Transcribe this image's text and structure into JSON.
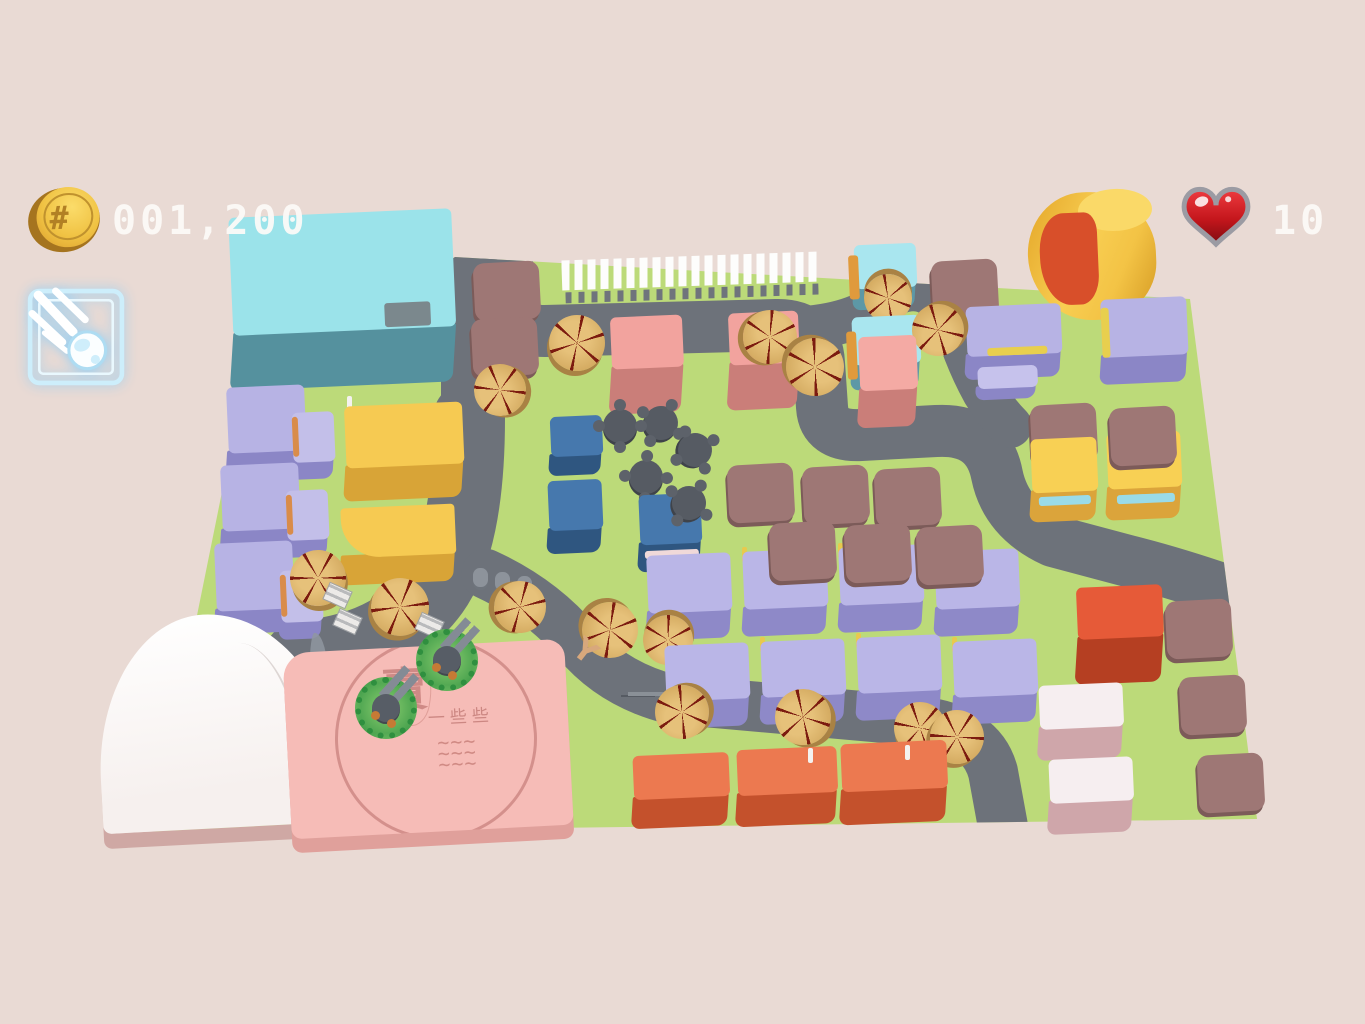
{
  "hud": {
    "coins": "001,200",
    "lives": "10",
    "coin_icon": "gold-coin",
    "heart_icon": "red-heart",
    "ability_icon": "meteor-spell",
    "coin_symbol": "#",
    "text_color": "#fdfbf8"
  },
  "colors": {
    "background": "#e9dad4",
    "ground": "#bcda79",
    "road": "#6d727a",
    "pad": "#9e7775",
    "tree_top": "#d9b369",
    "tree_spokes": "#7c1b10",
    "plaza": "#f6bcb7",
    "heart_red": "#d01f24",
    "ability_blue": "#bfe7f7"
  },
  "plaza": {
    "stamp_main": "賣",
    "stamp_small": "一些些",
    "stamp_waves": "~~~\n~~~\n~~~"
  },
  "map": {
    "ground_clip": "polygon(455px 257px, 1190px 299px, 1257px 819px, 153px 833px, 242px 393px)",
    "roads": [
      {
        "d": "M507,248 L507,296 Q507,331 545,331 L776,325 Q817,324 819,363 L822,407 Q824,437 861,435 L936,431 Q988,428 997,475 Q1006,519 1053,541 L1128,561 Q1180,574 1242,596",
        "w": 52
      },
      {
        "d": "M469,252 L469,430",
        "w": 56
      },
      {
        "d": "M469,418 Q469,542 433,592 Q398,640 328,653 L300,657",
        "w": 72
      },
      {
        "d": "M486,574 Q542,600 577,642 Q612,684 670,699 L918,721 Q981,728 993,772 L1004,832",
        "w": 50
      },
      {
        "d": "M788,329 Q852,327 882,302 Q906,283 927,292 Q950,303 958,331 Q968,363 984,392 Q996,412 1010,426",
        "w": 44
      }
    ],
    "buildings": [
      {
        "n": "cyan-building",
        "x": 232,
        "y": 213,
        "w": 223,
        "h": 118,
        "ex": 58,
        "top": "#9be3ea",
        "side": "#55919e",
        "acc": [
          {
            "x": 152,
            "y": 92,
            "w": 46,
            "h": 24,
            "c": "#7b888d"
          }
        ]
      },
      {
        "n": "lavender-building",
        "x": 228,
        "y": 386,
        "w": 78,
        "h": 66,
        "ex": 26,
        "top": "#b7b3e4",
        "side": "#8b86c6"
      },
      {
        "n": "lavender-building",
        "x": 293,
        "y": 412,
        "w": 42,
        "h": 50,
        "ex": 20,
        "top": "#c3bfe9",
        "side": "#8b86c6",
        "acc": [
          {
            "x": 0,
            "y": 4,
            "w": 6,
            "h": 40,
            "c": "#d98c4a"
          }
        ]
      },
      {
        "n": "lavender-building",
        "x": 222,
        "y": 464,
        "w": 78,
        "h": 66,
        "ex": 26,
        "top": "#b7b3e4",
        "side": "#8b86c6"
      },
      {
        "n": "lavender-building",
        "x": 287,
        "y": 490,
        "w": 42,
        "h": 50,
        "ex": 20,
        "top": "#c3bfe9",
        "side": "#8b86c6",
        "acc": [
          {
            "x": 0,
            "y": 4,
            "w": 6,
            "h": 40,
            "c": "#d98c4a"
          }
        ]
      },
      {
        "n": "lavender-building",
        "x": 216,
        "y": 542,
        "w": 78,
        "h": 68,
        "ex": 26,
        "top": "#b7b3e4",
        "side": "#8b86c6"
      },
      {
        "n": "lavender-building",
        "x": 281,
        "y": 570,
        "w": 42,
        "h": 52,
        "ex": 20,
        "top": "#c3bfe9",
        "side": "#8b86c6",
        "acc": [
          {
            "x": 0,
            "y": 4,
            "w": 6,
            "h": 42,
            "c": "#d98c4a"
          }
        ]
      },
      {
        "n": "yellow-building",
        "x": 346,
        "y": 404,
        "w": 118,
        "h": 62,
        "ex": 36,
        "top": "#f6ca52",
        "side": "#d8a437"
      },
      {
        "n": "yellow-building",
        "x": 342,
        "y": 506,
        "w": 114,
        "h": 50,
        "ex": 30,
        "top": "#f6ca52",
        "side": "#d8a437",
        "rad": "4px 4px 4px 38px"
      },
      {
        "n": "pink-building",
        "x": 612,
        "y": 316,
        "w": 72,
        "h": 52,
        "ex": 48,
        "top": "#f2a39e",
        "side": "#ca7e79"
      },
      {
        "n": "pink-building",
        "x": 730,
        "y": 312,
        "w": 70,
        "h": 52,
        "ex": 48,
        "top": "#f2a39e",
        "side": "#ca7e79"
      },
      {
        "n": "pink-building",
        "x": 860,
        "y": 336,
        "w": 58,
        "h": 54,
        "ex": 40,
        "top": "#f4aaa4",
        "side": "#ca7e79"
      },
      {
        "n": "cyan-shop",
        "x": 855,
        "y": 244,
        "w": 62,
        "h": 44,
        "ex": 24,
        "top": "#a9e6ef",
        "side": "#5d98a6",
        "acc": [
          {
            "x": -6,
            "y": 10,
            "w": 10,
            "h": 44,
            "c": "#e09a3c"
          }
        ]
      },
      {
        "n": "cyan-shop",
        "x": 853,
        "y": 316,
        "w": 68,
        "h": 48,
        "ex": 28,
        "top": "#a9e6ef",
        "side": "#5d98a6",
        "acc": [
          {
            "x": -6,
            "y": 14,
            "w": 10,
            "h": 48,
            "c": "#e09a3c"
          }
        ]
      },
      {
        "n": "lavender-building",
        "x": 967,
        "y": 305,
        "w": 95,
        "h": 50,
        "ex": 26,
        "top": "#b7b3e4",
        "side": "#8b86c6",
        "acc": [
          {
            "x": 20,
            "y": 42,
            "w": 60,
            "h": 8,
            "c": "#e8cf4e"
          }
        ]
      },
      {
        "n": "lavender-building",
        "x": 978,
        "y": 366,
        "w": 60,
        "h": 22,
        "ex": 14,
        "top": "#c6c2ec",
        "side": "#8b86c6"
      },
      {
        "n": "lavender-building",
        "x": 1102,
        "y": 298,
        "w": 86,
        "h": 58,
        "ex": 30,
        "top": "#b7b3e4",
        "side": "#8b86c6",
        "acc": [
          {
            "x": 0,
            "y": 8,
            "w": 8,
            "h": 50,
            "c": "#e8cf4e"
          }
        ]
      },
      {
        "n": "yellow-cylinder",
        "x": 1028,
        "y": 192,
        "w": 128,
        "h": 128,
        "ex": 0,
        "top": "linear-gradient(115deg,#e8ae31 10%,#f8ce52 45%,#f3c345 70%,#d9a028 95%)",
        "side": "",
        "rad": "46% 54% 48% 52%/50% 50% 46% 54%",
        "acc": [
          {
            "x": 52,
            "y": -2,
            "w": 74,
            "h": 42,
            "c": "#fad968",
            "r": "50%"
          },
          {
            "x": 12,
            "y": 20,
            "w": 58,
            "h": 92,
            "c": "#d84f2a",
            "r": "42% 22% 32% 52%"
          }
        ]
      },
      {
        "n": "yellow-shop",
        "x": 1032,
        "y": 438,
        "w": 66,
        "h": 54,
        "ex": 32,
        "top": "#f8d054",
        "side": "#dba43b",
        "acc": [
          {
            "x": 6,
            "y": 58,
            "w": 52,
            "h": 9,
            "c": "#9adbe8"
          }
        ]
      },
      {
        "n": "yellow-shop",
        "x": 1108,
        "y": 432,
        "w": 74,
        "h": 56,
        "ex": 34,
        "top": "#f8d054",
        "side": "#dba43b",
        "acc": [
          {
            "x": 8,
            "y": 62,
            "w": 58,
            "h": 9,
            "c": "#9adbe8"
          }
        ]
      },
      {
        "n": "blue-building",
        "x": 551,
        "y": 416,
        "w": 52,
        "h": 40,
        "ex": 22,
        "top": "#4678ad",
        "side": "#2f5680"
      },
      {
        "n": "blue-building",
        "x": 549,
        "y": 480,
        "w": 54,
        "h": 50,
        "ex": 26,
        "top": "#4678ad",
        "side": "#2f5680"
      },
      {
        "n": "blue-building",
        "x": 640,
        "y": 494,
        "w": 62,
        "h": 50,
        "ex": 30,
        "top": "#4678ad",
        "side": "#2f5680",
        "acc": [
          {
            "x": 4,
            "y": 56,
            "w": 54,
            "h": 8,
            "c": "#f0d9d9"
          }
        ]
      },
      {
        "n": "red-building",
        "x": 1078,
        "y": 586,
        "w": 86,
        "h": 52,
        "ex": 48,
        "top": "#e65a38",
        "side": "#b53f22"
      },
      {
        "n": "lavender-building",
        "x": 648,
        "y": 554,
        "w": 84,
        "h": 58,
        "ex": 30,
        "top": "#bab6e7",
        "side": "#8e89c8"
      },
      {
        "n": "lavender-building",
        "x": 744,
        "y": 550,
        "w": 84,
        "h": 58,
        "ex": 30,
        "top": "#bab6e7",
        "side": "#8e89c8"
      },
      {
        "n": "lavender-building",
        "x": 840,
        "y": 546,
        "w": 84,
        "h": 58,
        "ex": 30,
        "top": "#bab6e7",
        "side": "#8e89c8"
      },
      {
        "n": "lavender-building",
        "x": 936,
        "y": 550,
        "w": 84,
        "h": 58,
        "ex": 30,
        "top": "#bab6e7",
        "side": "#8e89c8"
      },
      {
        "n": "lavender-building",
        "x": 666,
        "y": 644,
        "w": 84,
        "h": 56,
        "ex": 30,
        "top": "#bab6e7",
        "side": "#8e89c8"
      },
      {
        "n": "lavender-building",
        "x": 762,
        "y": 640,
        "w": 84,
        "h": 56,
        "ex": 30,
        "top": "#bab6e7",
        "side": "#8e89c8"
      },
      {
        "n": "lavender-building",
        "x": 858,
        "y": 636,
        "w": 84,
        "h": 56,
        "ex": 30,
        "top": "#bab6e7",
        "side": "#8e89c8"
      },
      {
        "n": "lavender-building",
        "x": 954,
        "y": 640,
        "w": 84,
        "h": 56,
        "ex": 30,
        "top": "#bab6e7",
        "side": "#8e89c8"
      },
      {
        "n": "white-building",
        "x": 1040,
        "y": 684,
        "w": 84,
        "h": 44,
        "ex": 34,
        "top": "#f6eef0",
        "side": "#cfa6aa"
      },
      {
        "n": "white-building",
        "x": 1050,
        "y": 758,
        "w": 84,
        "h": 44,
        "ex": 34,
        "top": "#f6eef0",
        "side": "#cfa6aa"
      },
      {
        "n": "orange-building",
        "x": 634,
        "y": 754,
        "w": 96,
        "h": 44,
        "ex": 32,
        "top": "#ec7950",
        "side": "#c4512c"
      },
      {
        "n": "orange-building",
        "x": 738,
        "y": 748,
        "w": 100,
        "h": 46,
        "ex": 34,
        "top": "#ec7950",
        "side": "#c4512c"
      },
      {
        "n": "orange-building",
        "x": 842,
        "y": 742,
        "w": 106,
        "h": 48,
        "ex": 36,
        "top": "#ec7950",
        "side": "#c4512c"
      }
    ],
    "pads": [
      [
        507,
        291
      ],
      [
        505,
        347
      ],
      [
        965,
        289
      ],
      [
        761,
        493
      ],
      [
        836,
        495
      ],
      [
        908,
        497
      ],
      [
        803,
        551
      ],
      [
        878,
        553
      ],
      [
        950,
        555
      ],
      [
        1064,
        433
      ],
      [
        1143,
        436
      ],
      [
        1199,
        629
      ],
      [
        1213,
        705
      ],
      [
        1231,
        783
      ]
    ],
    "trees": [
      [
        577,
        343,
        56
      ],
      [
        770,
        337,
        54
      ],
      [
        815,
        367,
        58
      ],
      [
        888,
        298,
        48
      ],
      [
        938,
        330,
        52
      ],
      [
        500,
        390,
        52
      ],
      [
        318,
        578,
        56
      ],
      [
        400,
        607,
        58
      ],
      [
        520,
        607,
        52
      ],
      [
        610,
        630,
        56
      ],
      [
        668,
        640,
        50
      ],
      [
        682,
        712,
        54
      ],
      [
        803,
        717,
        56
      ],
      [
        920,
        728,
        52
      ],
      [
        957,
        737,
        54
      ]
    ],
    "tables": [
      [
        620,
        426
      ],
      [
        661,
        423
      ],
      [
        695,
        450
      ],
      [
        646,
        477
      ],
      [
        689,
        503
      ]
    ],
    "turrets": [
      [
        447,
        660
      ],
      [
        386,
        708
      ]
    ],
    "bins": [
      [
        480,
        577
      ],
      [
        502,
        581
      ],
      [
        524,
        585
      ]
    ],
    "crates": [
      [
        336,
        594
      ],
      [
        346,
        620
      ],
      [
        428,
        624
      ]
    ],
    "posts_yellow": [
      [
        742,
        547
      ],
      [
        838,
        543
      ],
      [
        934,
        547
      ],
      [
        760,
        637
      ],
      [
        856,
        633
      ],
      [
        952,
        637
      ]
    ],
    "posts_white": [
      [
        710,
        753
      ],
      [
        808,
        748
      ],
      [
        905,
        745
      ],
      [
        347,
        396
      ]
    ],
    "bench": [
      628,
      692
    ],
    "branch": {
      "x": 574,
      "y": 634,
      "glyph": "Y"
    }
  }
}
